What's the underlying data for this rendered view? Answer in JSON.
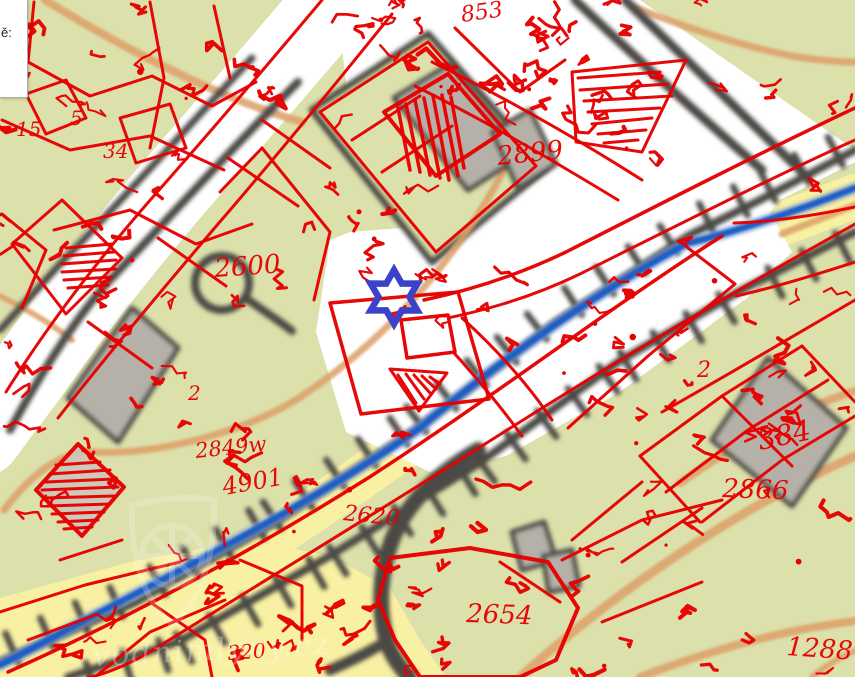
{
  "info_box": {
    "label": "ě:"
  },
  "marker": {
    "kind": "mill-location",
    "shape": "six-pointed-star-outline",
    "color": "#3b42c9"
  },
  "watermark": {
    "text": "vodnimlyny.cz"
  },
  "map": {
    "colors": {
      "overlay_red": "#e60000",
      "background_olive": "#dce0ab",
      "field_yellow": "#f8f0a2",
      "contour_orange": "#dd9f68",
      "road_dark": "#4b4a44",
      "building_gray": "#b5b1a8",
      "stream_blue": "#1b5fc6",
      "marker_blue": "#3b42c9",
      "old_map_white": "#ffffff"
    },
    "labels": [
      {
        "text": "2600",
        "x": 215,
        "y": 277,
        "size": 26,
        "rot": -4
      },
      {
        "text": "2899",
        "x": 498,
        "y": 165,
        "size": 26,
        "rot": -6
      },
      {
        "text": "853",
        "x": 462,
        "y": 22,
        "size": 22,
        "rot": -8
      },
      {
        "text": "2866",
        "x": 722,
        "y": 497,
        "size": 26,
        "rot": 2
      },
      {
        "text": "384",
        "x": 760,
        "y": 450,
        "size": 28,
        "rot": -12
      },
      {
        "text": "1288",
        "x": 786,
        "y": 655,
        "size": 26,
        "rot": 4
      },
      {
        "text": "2620",
        "x": 343,
        "y": 520,
        "size": 22,
        "rot": 6
      },
      {
        "text": "2654",
        "x": 466,
        "y": 622,
        "size": 26,
        "rot": 2
      },
      {
        "text": "4901",
        "x": 224,
        "y": 495,
        "size": 24,
        "rot": -10
      },
      {
        "text": "2849w",
        "x": 196,
        "y": 458,
        "size": 21,
        "rot": -6
      },
      {
        "text": "320",
        "x": 228,
        "y": 660,
        "size": 20,
        "rot": -4
      },
      {
        "text": "15",
        "x": 16,
        "y": 136,
        "size": 20,
        "rot": 0
      },
      {
        "text": "5",
        "x": 70,
        "y": 125,
        "size": 20,
        "rot": 0
      },
      {
        "text": "34",
        "x": 103,
        "y": 158,
        "size": 20,
        "rot": 0
      },
      {
        "text": "2",
        "x": 697,
        "y": 377,
        "size": 22,
        "rot": 0
      },
      {
        "text": "2",
        "x": 188,
        "y": 400,
        "size": 20,
        "rot": 0
      }
    ]
  }
}
